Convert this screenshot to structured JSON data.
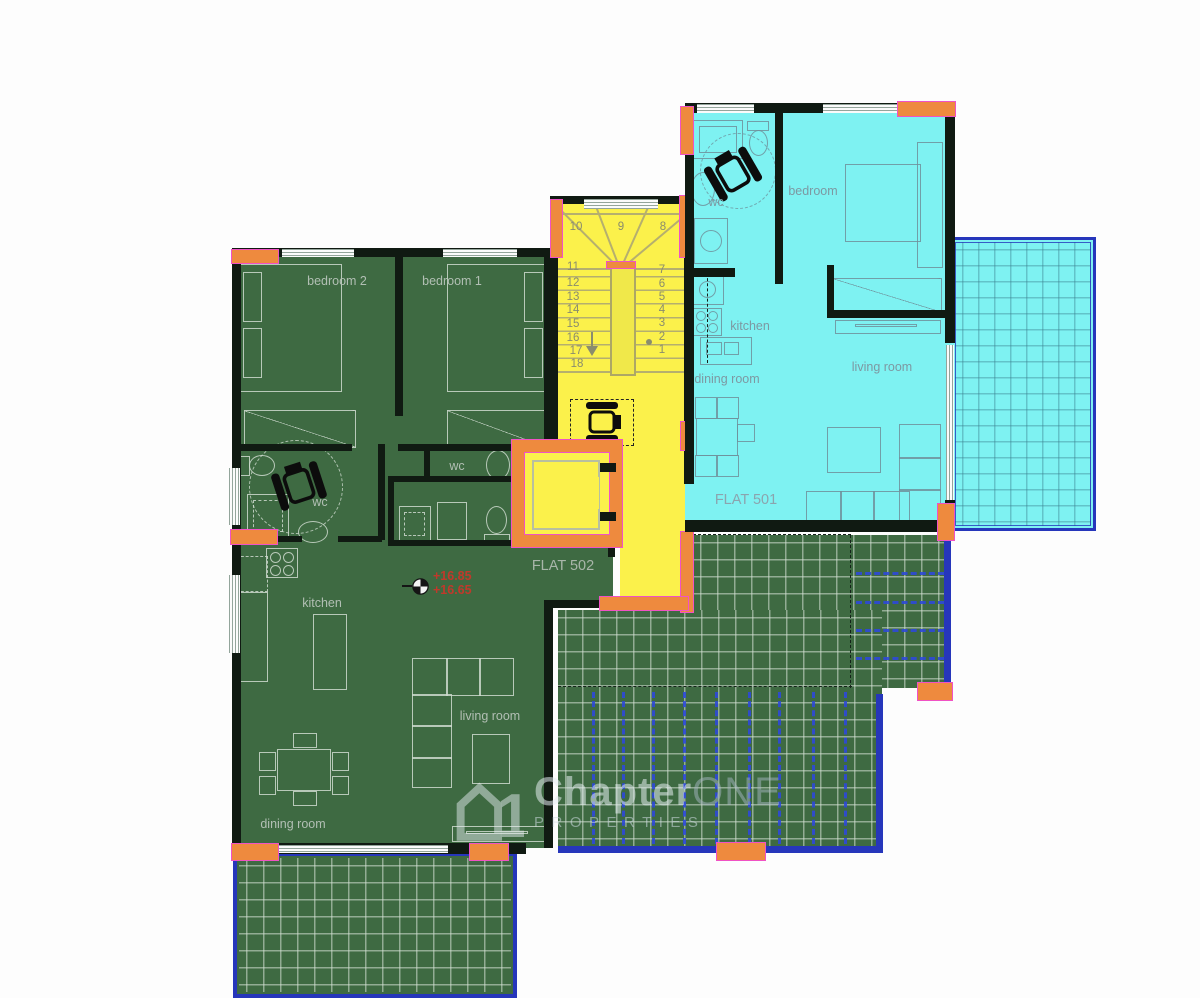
{
  "flat501": {
    "name": "FLAT 501",
    "rooms": {
      "wc": "wc",
      "bedroom": "bedroom",
      "kitchen": "kitchen",
      "dining": "dining room",
      "living": "living room"
    }
  },
  "flat502": {
    "name": "FLAT 502",
    "rooms": {
      "bedroom2": "bedroom 2",
      "bedroom1": "bedroom 1",
      "wc": "wc",
      "wc_small": "wc",
      "kitchen": "kitchen",
      "dining": "dining room",
      "living": "living room"
    }
  },
  "levels": {
    "upper": "+16.85",
    "lower": "+16.65"
  },
  "stairs": {
    "numbers": [
      "1",
      "2",
      "3",
      "4",
      "5",
      "6",
      "7",
      "8",
      "9",
      "10",
      "11",
      "12",
      "13",
      "14",
      "15",
      "16",
      "17",
      "18"
    ]
  },
  "watermark": {
    "brand_first": "Chapter",
    "brand_second": "ONE",
    "subtitle": "PROPERTIES",
    "logo_digit": "1"
  },
  "colors": {
    "flat501_fill": "#7EF2F2",
    "flat502_fill": "#3E6A42",
    "core_fill": "#FBF14B",
    "wall": "#101A12",
    "accent_orange": "#EE8A3E",
    "accent_magenta": "#F052C5",
    "terrace_border_blue": "#2636BB",
    "pergola_blue": "#2E49D8",
    "level_text_red": "#C0392B"
  }
}
